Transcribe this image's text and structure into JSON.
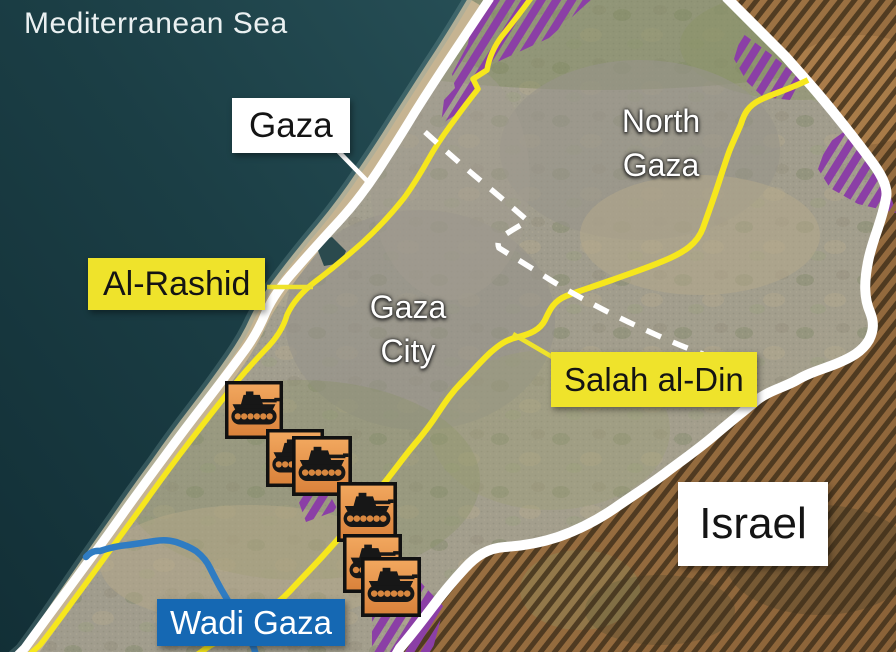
{
  "map": {
    "sea_label": "Mediterranean Sea",
    "regions": {
      "north_gaza": {
        "lines": [
          "North",
          "Gaza"
        ]
      },
      "gaza_city": {
        "lines": [
          "Gaza",
          "City"
        ]
      },
      "israel": "Israel"
    },
    "callouts": {
      "gaza": "Gaza",
      "al_rashid": "Al-Rashid",
      "salah_al_din": "Salah al-Din",
      "wadi_gaza": "Wadi Gaza"
    },
    "tanks": {
      "meaning": "tank-icon",
      "count": 6,
      "positions": [
        {
          "x": 225,
          "y": 381,
          "size": 58
        },
        {
          "x": 266,
          "y": 429,
          "size": 58
        },
        {
          "x": 292,
          "y": 436,
          "size": 60
        },
        {
          "x": 337,
          "y": 482,
          "size": 60
        },
        {
          "x": 343,
          "y": 534,
          "size": 59
        },
        {
          "x": 361,
          "y": 557,
          "size": 60
        }
      ]
    },
    "colors": {
      "road_yellow": "#f6e71d",
      "label_yellow": "#efe32b",
      "label_blue": "#1568b3",
      "purple_zone": "#8b3fa6",
      "river_blue": "#2f7cc3",
      "tank_orange": "#e89450",
      "border_white": "#ffffff",
      "sea_dark": "#17373d",
      "israel_brown": "#8a6638"
    }
  }
}
